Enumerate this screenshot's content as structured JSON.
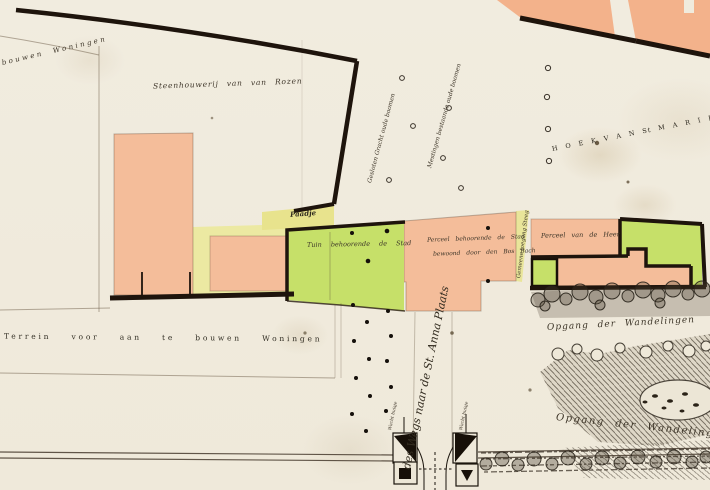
{
  "map": {
    "labels": {
      "arc_woningen": "bouwen Woningen",
      "steenhouwerij": "Steenhouwerij van van Rozen",
      "diag_gracht": "Gesloten Gracht oude boomen",
      "diag_mestingen": "Mestingen bestaande oude boomen",
      "hoek_van_st_marie": "H O E K   V A N   St   M A R I E",
      "paadje": "Paadje",
      "tuin_stad": "Tuin behoorende de Stad",
      "perceel_stad_regel1": "Perceel behoorende de Stad",
      "perceel_stad_regel2": "bewoond door den Bos Bach",
      "steeg": "Gemeene toegang Steeg",
      "perceel_heer": "Perceel van de Heer",
      "weg_anna": "des Wegs naar de St. Anna Plaats",
      "terrein": "Terrein voor aan te bouwen Woningen",
      "opgang_1": "Opgang der Wandelingen",
      "opgang_2": "Opgang der Wandelingen",
      "wachthuisje_links": "Wacht huisje",
      "wachthuisje_rechts": "Wacht huisje"
    },
    "colors": {
      "paper": "#f1ecdf",
      "parcel_salmon": "#f4bd9a",
      "parcel_salmon_top": "#f3b28b",
      "parcel_green": "#c6e069",
      "parcel_yellow": "#ece9a2",
      "ink": "#1a130b",
      "script_ink": "#3d3528"
    }
  }
}
